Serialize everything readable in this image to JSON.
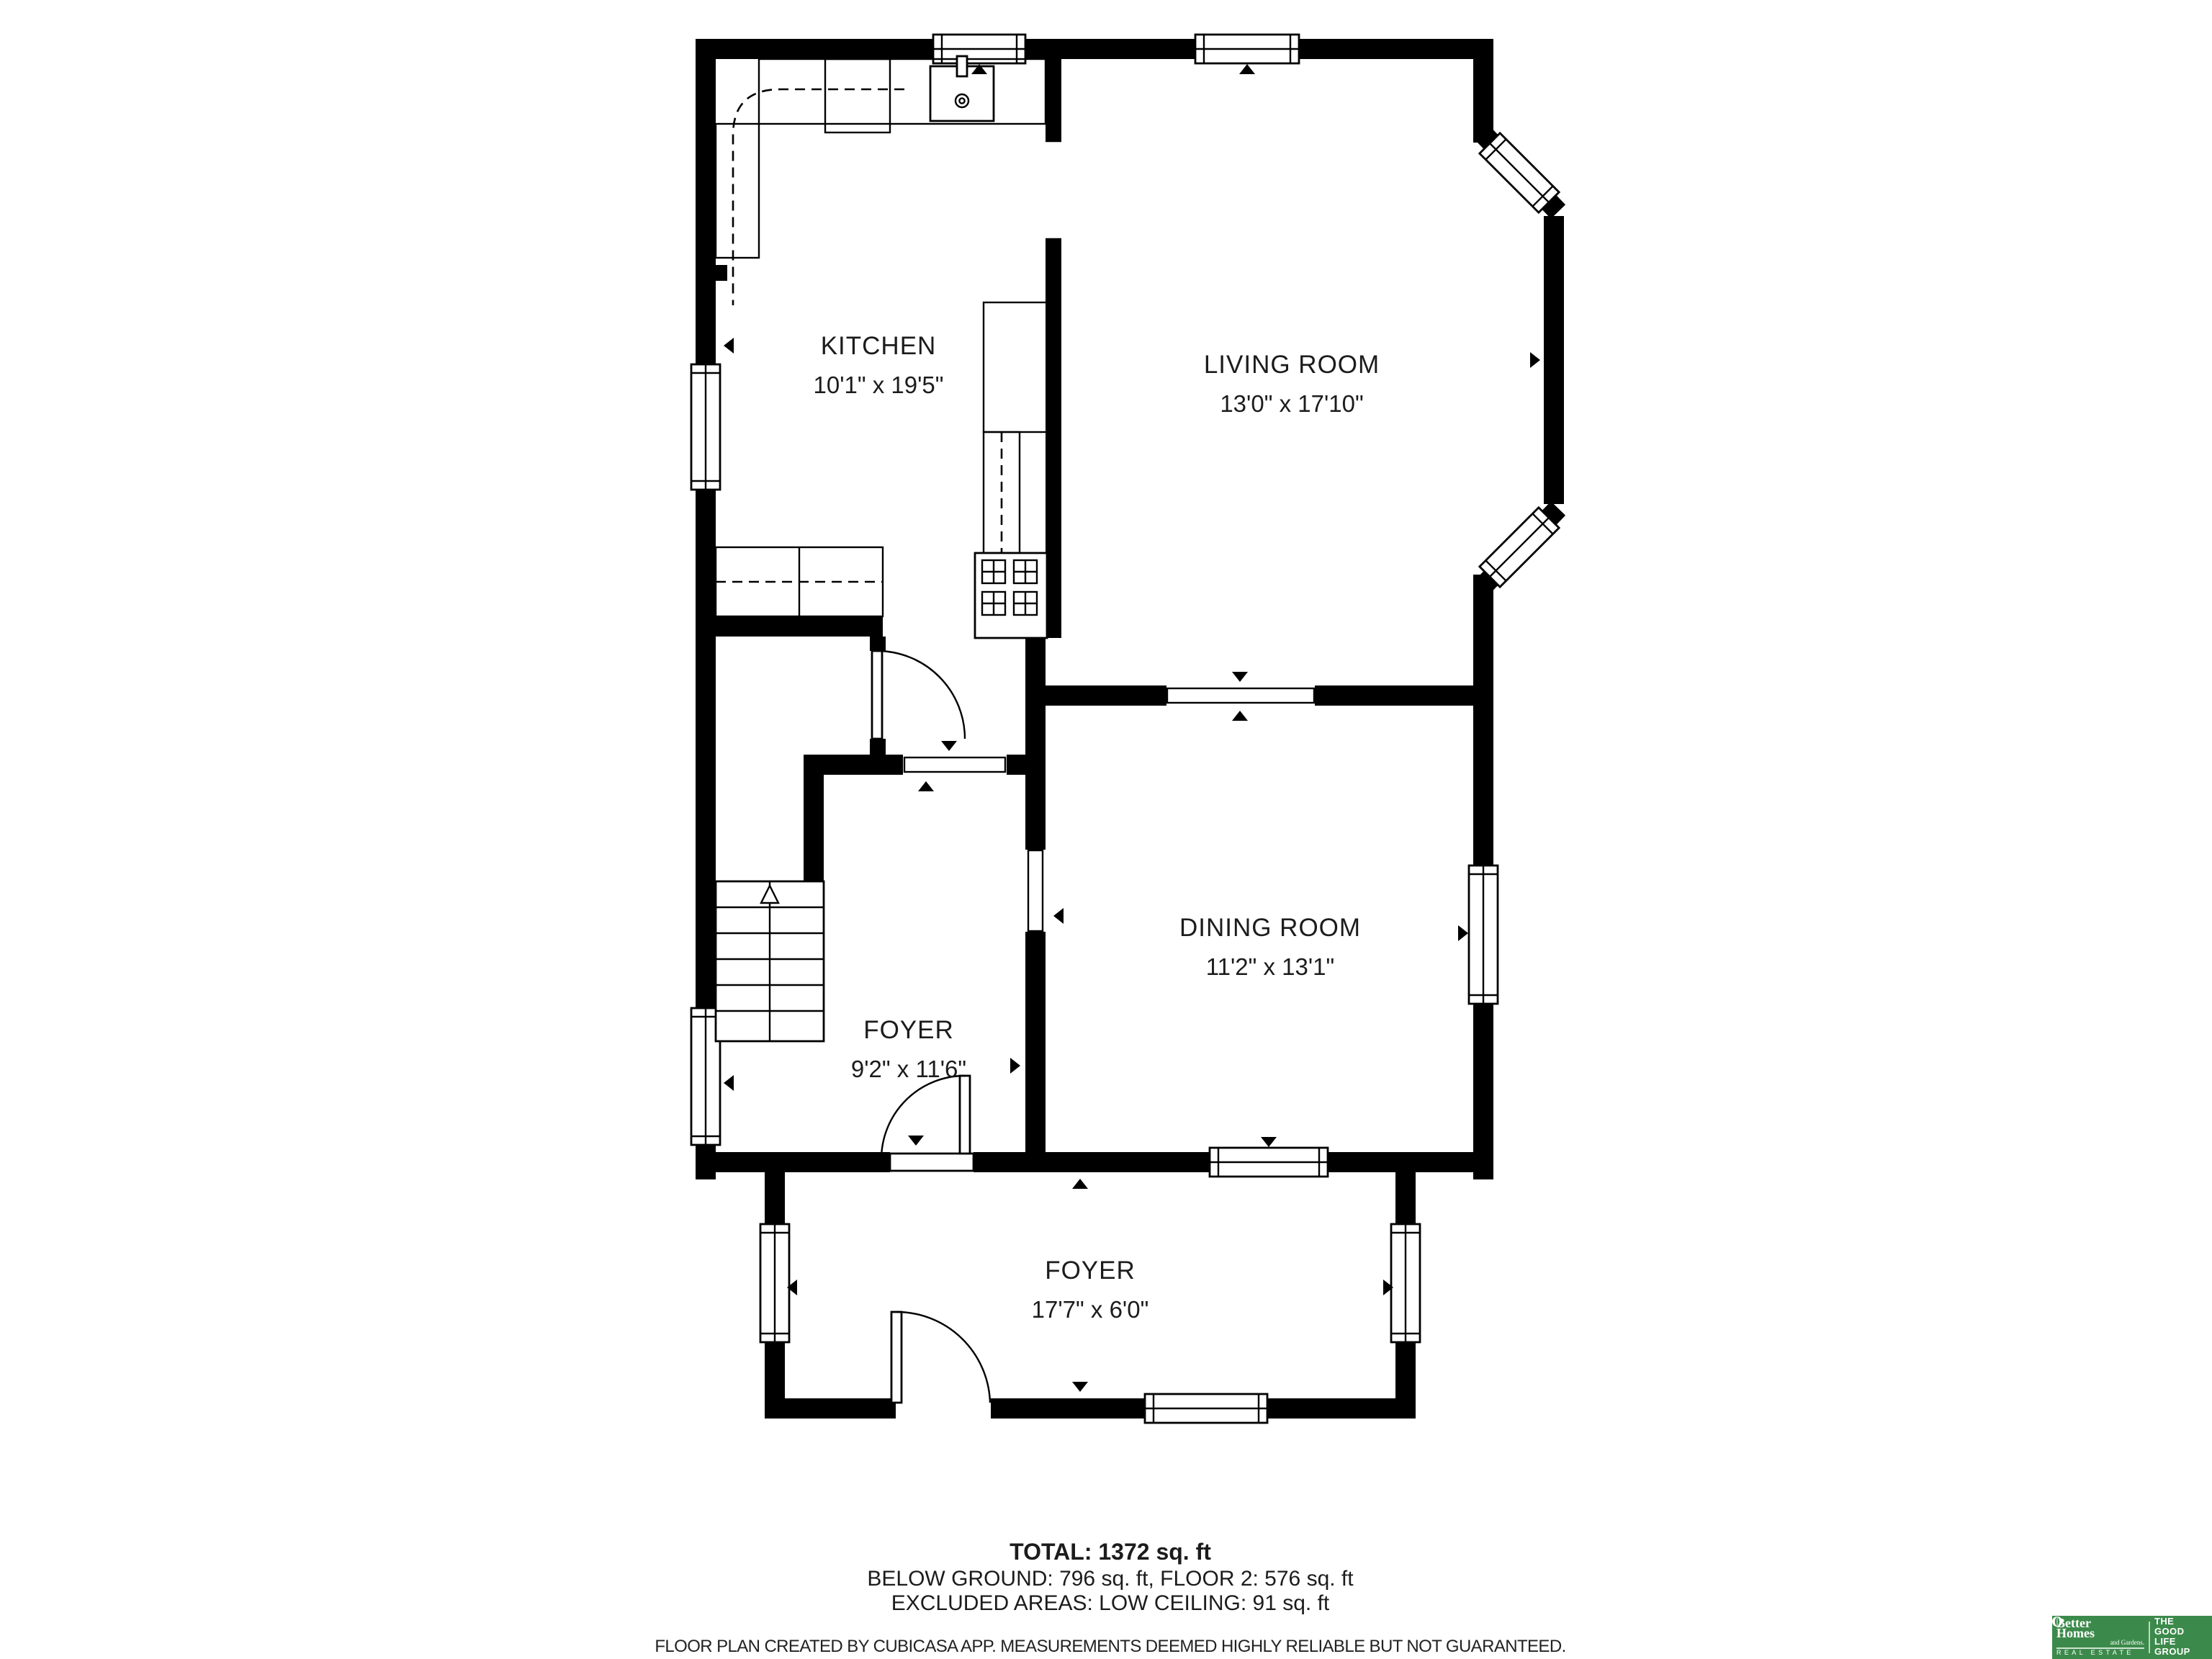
{
  "floor_plan": {
    "rooms": [
      {
        "name": "KITCHEN",
        "dimensions": "10'1\" x 19'5\""
      },
      {
        "name": "LIVING ROOM",
        "dimensions": "13'0\" x 17'10\""
      },
      {
        "name": "DINING ROOM",
        "dimensions": "11'2\" x 13'1\""
      },
      {
        "name": "FOYER",
        "dimensions": "9'2\" x 11'6\""
      },
      {
        "name": "FOYER",
        "dimensions": "17'7\" x 6'0\""
      }
    ],
    "wall_color": "#000000",
    "floor_color": "#ffffff"
  },
  "summary": {
    "total": "TOTAL: 1372 sq. ft",
    "breakdown": "BELOW GROUND: 796 sq. ft, FLOOR 2: 576 sq. ft",
    "excluded": "EXCLUDED AREAS: LOW CEILING: 91 sq. ft"
  },
  "disclaimer": "FLOOR PLAN CREATED BY CUBICASA APP. MEASUREMENTS DEEMED HIGHLY RELIABLE BUT NOT GUARANTEED.",
  "logo": {
    "brand_line1": "Better",
    "brand_line2": "Homes",
    "brand_sub": "and Gardens.",
    "brand_tagline": "REAL ESTATE",
    "group_lines": [
      "THE",
      "GOOD LIFE",
      "GROUP"
    ],
    "bg_color": "#3c8a4b",
    "text_color": "#ffffff",
    "leaf_icon": "leaf-icon"
  }
}
